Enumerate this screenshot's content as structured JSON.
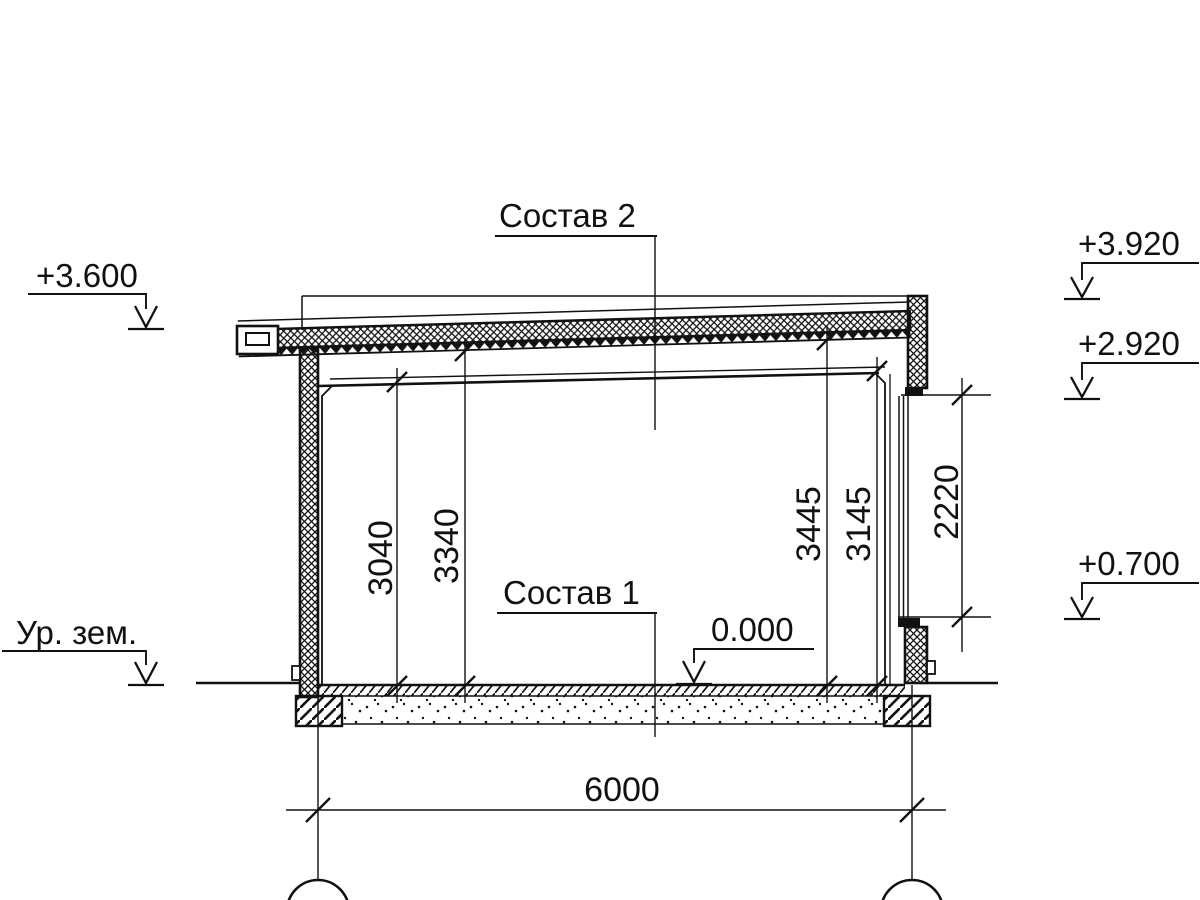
{
  "drawing": {
    "type": "architectural-section",
    "background": "#ffffff",
    "line_color": "#111111",
    "labels": {
      "roof_assembly": "Состав 2",
      "floor_assembly": "Состав 1",
      "ground_level": "Ур. зем."
    },
    "elevations": {
      "left_roof": "+3.600",
      "parapet_top": "+3.920",
      "window_head": "+2.920",
      "window_sill": "+0.700",
      "floor_zero": "0.000"
    },
    "dimensions": {
      "left_clear_height": "3040",
      "left_to_deck": "3340",
      "right_to_deck": "3445",
      "right_clear_height": "3145",
      "window_height": "2220",
      "span": "6000"
    }
  }
}
